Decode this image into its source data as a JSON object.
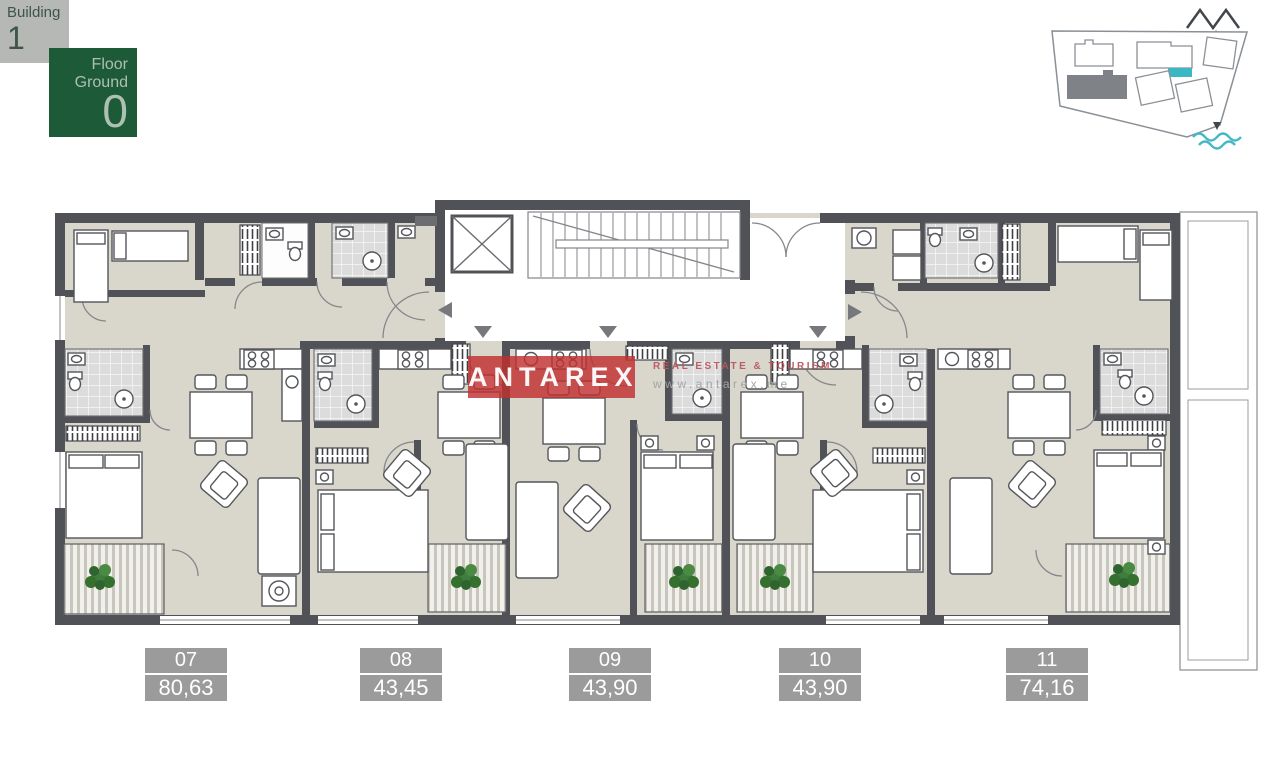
{
  "header": {
    "building_badge": {
      "label": "Building",
      "number": "1"
    },
    "floor_badge": {
      "label": "Floor",
      "level_name": "Ground",
      "level_number": "0"
    }
  },
  "watermark": {
    "brand": "ANTAREX",
    "tagline": "REAL ESTATE & TOURISM",
    "website": "www.antarex.me"
  },
  "units": [
    {
      "number": "07",
      "area": "80,63"
    },
    {
      "number": "08",
      "area": "43,45"
    },
    {
      "number": "09",
      "area": "43,90"
    },
    {
      "number": "10",
      "area": "43,90"
    },
    {
      "number": "11",
      "area": "74,16"
    }
  ],
  "site_plan": {
    "highlighted_building_color": "#3cb8c4",
    "current_building_fill": "#7f8387",
    "sea_color": "#45b8c6",
    "icons": [
      "mountains-icon",
      "north-arrow-icon",
      "sea-arrow-icon",
      "sea-waves-icon"
    ]
  },
  "colors": {
    "wall": "#515257",
    "floor": "#d9d6cc",
    "unit_label_bg": "#9b9b9b",
    "badge_bg_gray": "#b5b8b5",
    "badge_bg_green": "#1d5a37",
    "badge_text_dark": "#3e5548",
    "badge_text_light": "#aebfb3",
    "watermark_red": "#c13030",
    "tagline_red": "#be555c",
    "website_gray": "#a2a6a6",
    "plant_green": "#3e7d3e"
  }
}
